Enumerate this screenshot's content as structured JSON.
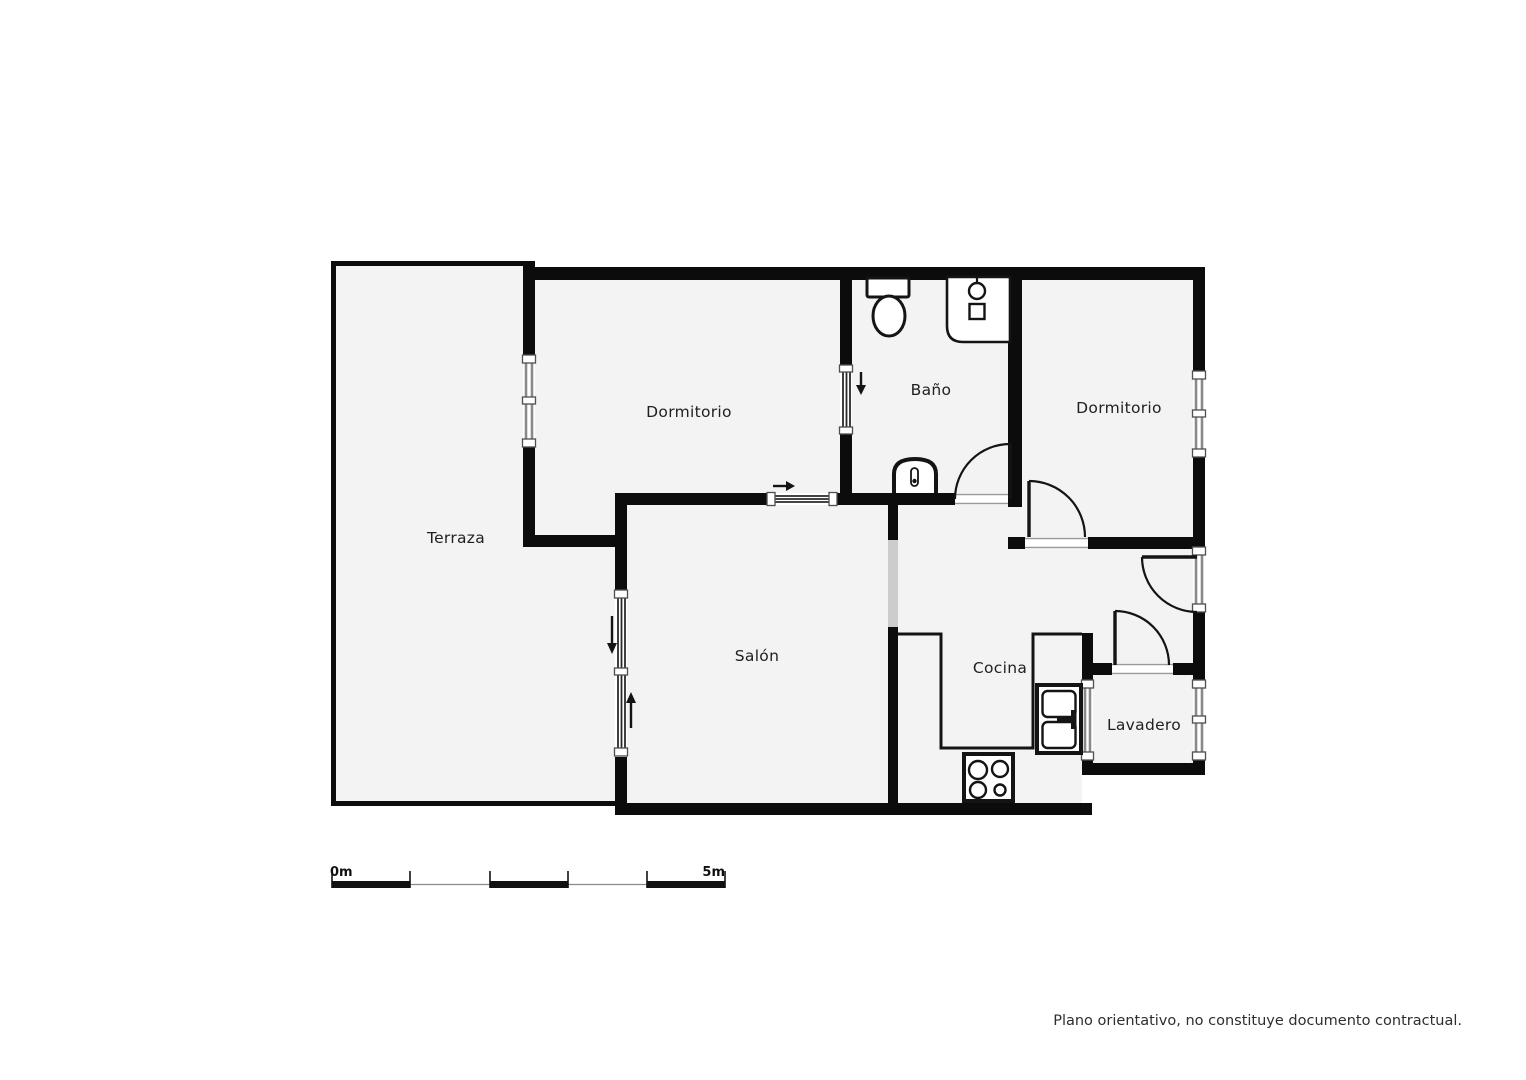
{
  "page": {
    "background": "#ffffff"
  },
  "colors": {
    "page": "#ffffff",
    "wall": "#0c0c0c",
    "floor": "#f3f3f3",
    "window": "#8a8a8a",
    "opening": "#cccccc",
    "text": "#1f1f1f"
  },
  "plan": {
    "rooms": {
      "terraza": {
        "label": "Terraza"
      },
      "dormitorio_left": {
        "label": "Dormitorio"
      },
      "bano": {
        "label": "Baño"
      },
      "dormitorio_right": {
        "label": "Dormitorio"
      },
      "salon": {
        "label": "Salón"
      },
      "cocina": {
        "label": "Cocina"
      },
      "lavadero": {
        "label": "Lavadero"
      }
    },
    "fixtures": [
      "toilet-icon",
      "bathroom-sink-icon",
      "bidet-icon",
      "stove-icon",
      "kitchen-sink-icon"
    ],
    "doors": [
      "bano-door",
      "dormitorio-right-door",
      "entry-door",
      "lavadero-door"
    ],
    "sliding_doors": [
      "dormitorio-bano-sliding",
      "salon-terraza-sliding",
      "dormitorio-salon-sliding"
    ],
    "windows": [
      "dormitorio-left-window",
      "dormitorio-right-window",
      "hall-window",
      "lavadero-window",
      "cocina-lavadero-window"
    ]
  },
  "scale_bar": {
    "start_label": "0m",
    "end_label": "5m"
  },
  "footer": {
    "disclaimer": "Plano orientativo, no constituye documento contractual."
  }
}
